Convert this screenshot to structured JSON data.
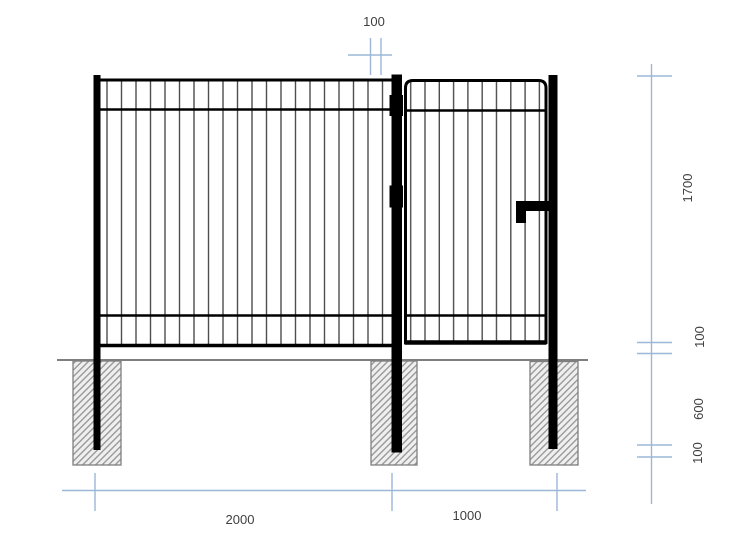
{
  "dimensions": {
    "top_gap": "100",
    "right_column": [
      "1700",
      "100",
      "600",
      "100"
    ],
    "bottom_row": [
      "2000",
      "1000"
    ]
  },
  "colors": {
    "dimension_line": "#9cb7d8",
    "drawing_black": "#000000",
    "picket_gray": "#4d4d4d",
    "ground_gray": "#7f7f7f",
    "hatch_gray": "#9a9a9a",
    "hatch_background": "#efefef",
    "label_text": "#3f3f3f",
    "page_background": "#ffffff"
  }
}
